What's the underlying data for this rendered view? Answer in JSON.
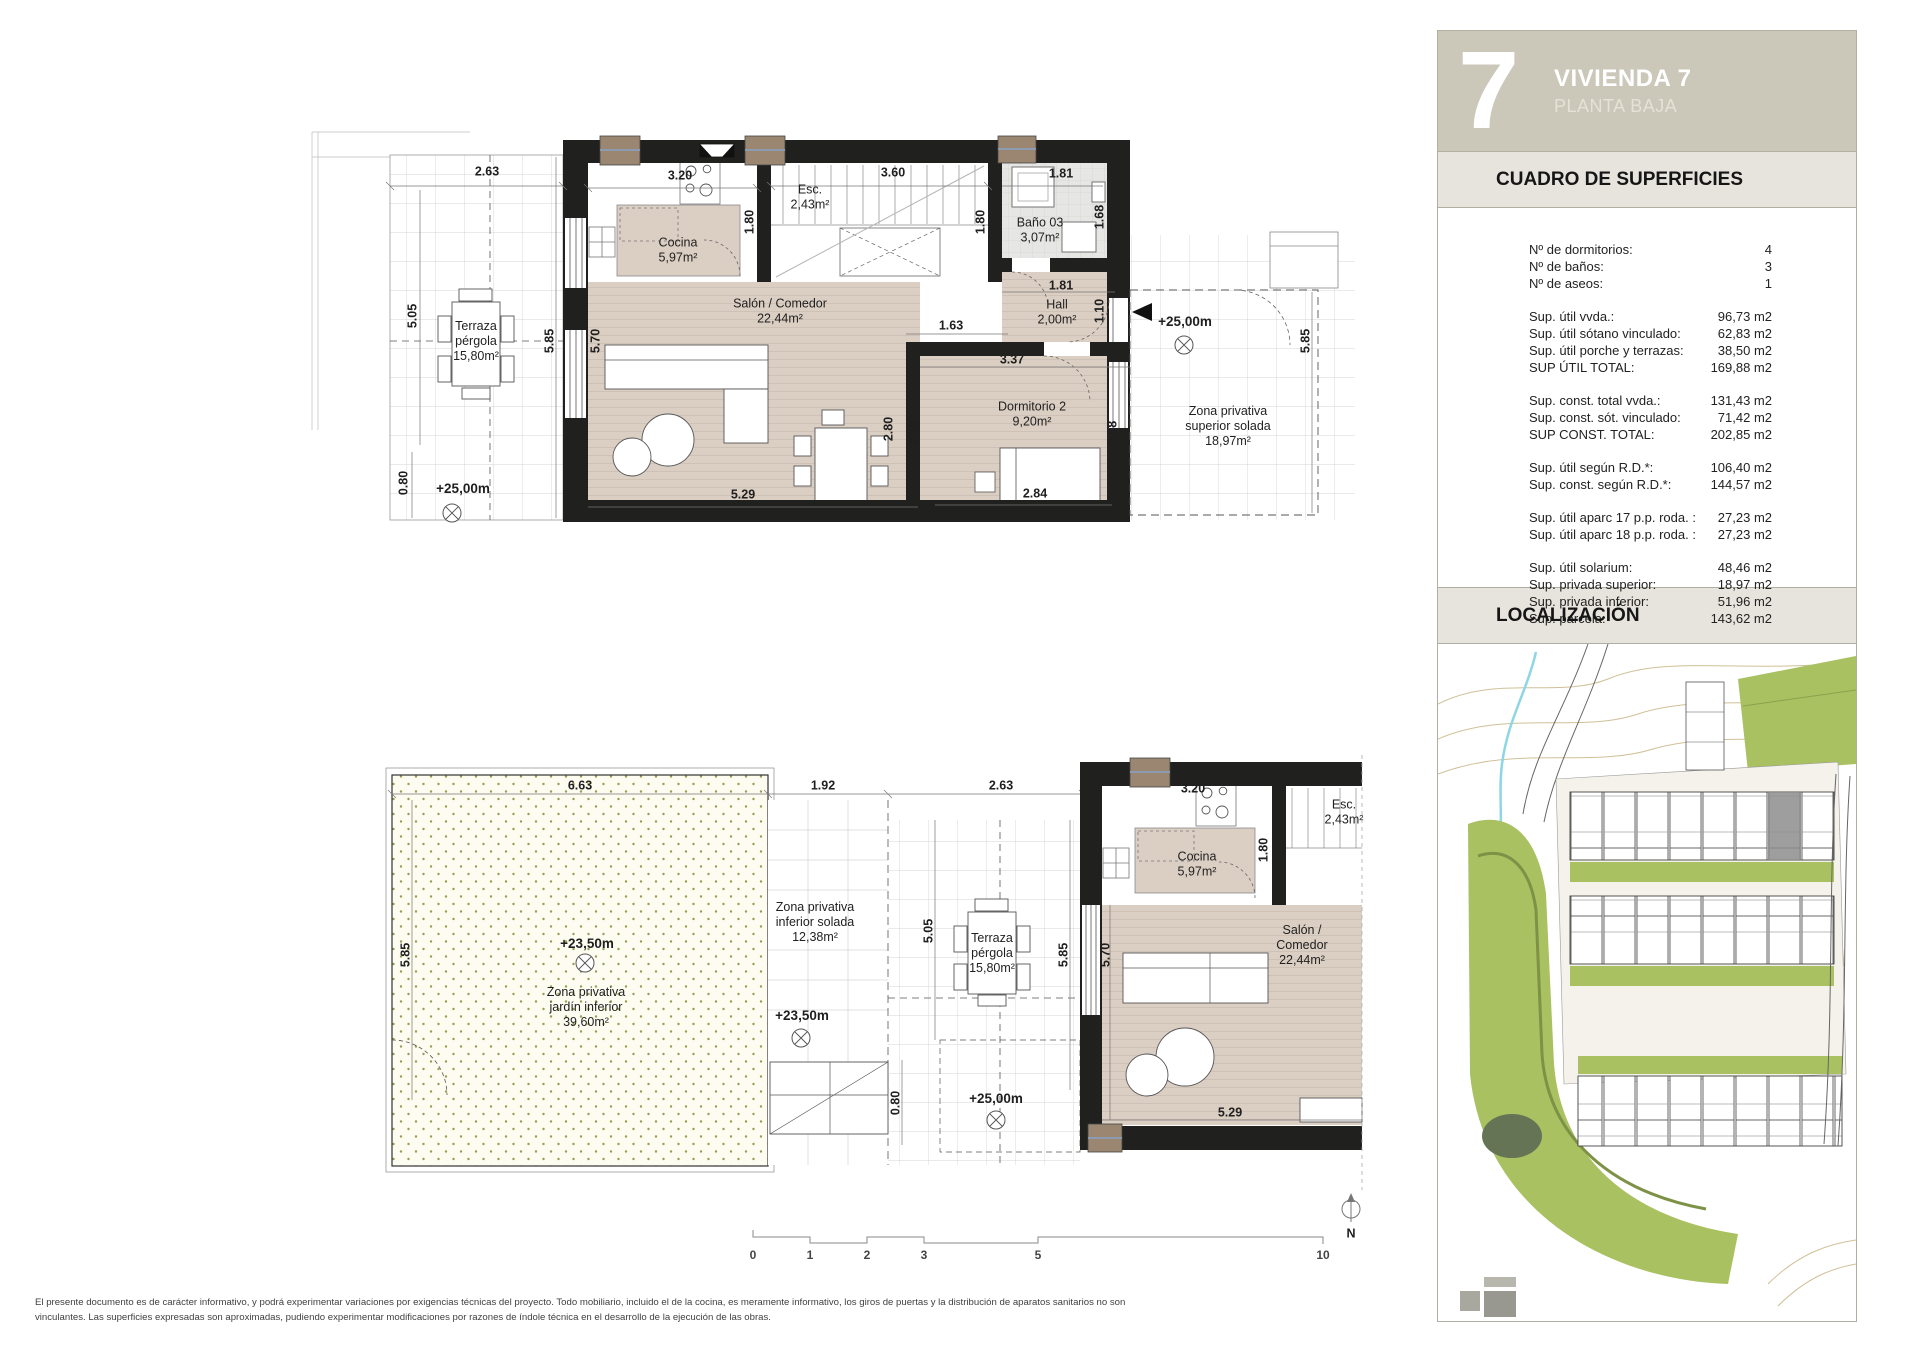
{
  "sidebar": {
    "unit_number": "7",
    "title": "VIVIENDA 7",
    "subtitle": "PLANTA BAJA",
    "surfaces_header": "CUADRO DE SUPERFICIES",
    "localization_header": "LOCALIZACIÓN",
    "surface_rows": [
      {
        "label": "Nº de dormitorios:",
        "value": "4"
      },
      {
        "label": "Nº de baños:",
        "value": "3"
      },
      {
        "label": "Nº de aseos:",
        "value": "1"
      },
      {
        "label": "Sup. útil vvda.:",
        "value": "96,73 m2",
        "gap": true
      },
      {
        "label": "Sup. útil sótano vinculado:",
        "value": "62,83 m2"
      },
      {
        "label": "Sup. útil porche y terrazas:",
        "value": "38,50 m2"
      },
      {
        "label": "SUP ÚTIL TOTAL:",
        "value": "169,88 m2"
      },
      {
        "label": "Sup. const. total vvda.:",
        "value": "131,43 m2",
        "gap": true
      },
      {
        "label": "Sup. const. sót. vinculado:",
        "value": "71,42 m2"
      },
      {
        "label": "SUP CONST. TOTAL:",
        "value": "202,85 m2"
      },
      {
        "label": "Sup. útil según R.D.*:",
        "value": "106,40 m2",
        "gap": true
      },
      {
        "label": "Sup. const. según R.D.*:",
        "value": "144,57 m2"
      },
      {
        "label": "Sup. útil aparc 17 p.p. roda. :",
        "value": "27,23 m2",
        "gap": true
      },
      {
        "label": "Sup. útil aparc 18 p.p. roda. :",
        "value": "27,23 m2"
      },
      {
        "label": "Sup. útil solarium:",
        "value": "48,46 m2",
        "gap": true
      },
      {
        "label": "Sup. privada superior:",
        "value": "18,97 m2"
      },
      {
        "label": "Sup. privada inferior:",
        "value": "51,96 m2"
      },
      {
        "label": "Sup. parcela:",
        "value": "143,62 m2"
      }
    ]
  },
  "plan_labels": [
    {
      "t": "2.63",
      "x": 487,
      "y": 172,
      "k": "dim"
    },
    {
      "t": "3.20",
      "x": 680,
      "y": 176,
      "k": "dim"
    },
    {
      "t": "3.60",
      "x": 893,
      "y": 173,
      "k": "dim"
    },
    {
      "t": "1.81",
      "x": 1061,
      "y": 174,
      "k": "dim"
    },
    {
      "t": "Esc.\n2,43m²",
      "x": 810,
      "y": 197,
      "k": "room"
    },
    {
      "t": "1.80",
      "x": 750,
      "y": 222,
      "k": "dim",
      "r": 1
    },
    {
      "t": "1.80",
      "x": 981,
      "y": 222,
      "k": "dim",
      "r": 1
    },
    {
      "t": "1.68",
      "x": 1100,
      "y": 217,
      "k": "dim",
      "r": 1
    },
    {
      "t": "Baño 03\n3,07m²",
      "x": 1040,
      "y": 230,
      "k": "room"
    },
    {
      "t": "Cocina\n5,97m²",
      "x": 678,
      "y": 250,
      "k": "room"
    },
    {
      "t": "Terraza\npérgola\n15,80m²",
      "x": 476,
      "y": 341,
      "k": "room"
    },
    {
      "t": "5.05",
      "x": 413,
      "y": 316,
      "k": "dim",
      "r": 1
    },
    {
      "t": "5.85",
      "x": 550,
      "y": 341,
      "k": "dim",
      "r": 1
    },
    {
      "t": "5.70",
      "x": 596,
      "y": 341,
      "k": "dim",
      "r": 1
    },
    {
      "t": "Salón / Comedor\n22,44m²",
      "x": 780,
      "y": 311,
      "k": "room"
    },
    {
      "t": "Hall\n2,00m²",
      "x": 1057,
      "y": 312,
      "k": "room"
    },
    {
      "t": "1.10",
      "x": 1100,
      "y": 311,
      "k": "dim",
      "r": 1
    },
    {
      "t": "1.81",
      "x": 1061,
      "y": 286,
      "k": "dim"
    },
    {
      "t": "1.63",
      "x": 951,
      "y": 326,
      "k": "dim"
    },
    {
      "t": "3.37",
      "x": 1012,
      "y": 360,
      "k": "dim"
    },
    {
      "t": "Dormitorio 2\n9,20m²",
      "x": 1032,
      "y": 414,
      "k": "room"
    },
    {
      "t": "2.80",
      "x": 889,
      "y": 429,
      "k": "dim",
      "r": 1
    },
    {
      "t": "2.58",
      "x": 915,
      "y": 433,
      "k": "dim",
      "r": 1
    },
    {
      "t": "2.68",
      "x": 1113,
      "y": 433,
      "k": "dim",
      "r": 1
    },
    {
      "t": "2.84",
      "x": 1035,
      "y": 494,
      "k": "dim"
    },
    {
      "t": "+25,00m",
      "x": 1185,
      "y": 322,
      "k": "lvl"
    },
    {
      "t": "Zona privativa\nsuperior solada\n18,97m²",
      "x": 1228,
      "y": 426,
      "k": "room"
    },
    {
      "t": "5.85",
      "x": 1306,
      "y": 341,
      "k": "dim",
      "r": 1
    },
    {
      "t": "+25,00m",
      "x": 463,
      "y": 489,
      "k": "lvl"
    },
    {
      "t": "0.80",
      "x": 404,
      "y": 483,
      "k": "dim",
      "r": 1
    },
    {
      "t": "5.29",
      "x": 743,
      "y": 495,
      "k": "dim"
    },
    {
      "t": "6.63",
      "x": 580,
      "y": 786,
      "k": "dim"
    },
    {
      "t": "1.92",
      "x": 823,
      "y": 786,
      "k": "dim"
    },
    {
      "t": "2.63",
      "x": 1001,
      "y": 786,
      "k": "dim"
    },
    {
      "t": "3.20",
      "x": 1193,
      "y": 789,
      "k": "dim"
    },
    {
      "t": "Esc.\n2,43m²",
      "x": 1344,
      "y": 812,
      "k": "room"
    },
    {
      "t": "1.80",
      "x": 1264,
      "y": 850,
      "k": "dim",
      "r": 1
    },
    {
      "t": "Cocina\n5,97m²",
      "x": 1197,
      "y": 864,
      "k": "room"
    },
    {
      "t": "5.85",
      "x": 406,
      "y": 955,
      "k": "dim",
      "r": 1
    },
    {
      "t": "+23,50m",
      "x": 587,
      "y": 944,
      "k": "lvl"
    },
    {
      "t": "Zona privativa\njardín inferior\n39,60m²",
      "x": 586,
      "y": 1007,
      "k": "room"
    },
    {
      "t": "Zona privativa\ninferior solada\n12,38m²",
      "x": 815,
      "y": 922,
      "k": "room"
    },
    {
      "t": "5.05",
      "x": 929,
      "y": 931,
      "k": "dim",
      "r": 1
    },
    {
      "t": "Terraza\npérgola\n15,80m²",
      "x": 992,
      "y": 953,
      "k": "room"
    },
    {
      "t": "5.85",
      "x": 1064,
      "y": 955,
      "k": "dim",
      "r": 1
    },
    {
      "t": "5.70",
      "x": 1106,
      "y": 955,
      "k": "dim",
      "r": 1
    },
    {
      "t": "+23,50m",
      "x": 802,
      "y": 1016,
      "k": "lvl"
    },
    {
      "t": "Salón / Comedor\n22,44m²",
      "x": 1302,
      "y": 945,
      "k": "room"
    },
    {
      "t": "0.80",
      "x": 896,
      "y": 1103,
      "k": "dim",
      "r": 1
    },
    {
      "t": "+25,00m",
      "x": 996,
      "y": 1099,
      "k": "lvl"
    },
    {
      "t": "5.29",
      "x": 1230,
      "y": 1113,
      "k": "dim"
    },
    {
      "t": "N",
      "x": 1351,
      "y": 1234,
      "k": "dim"
    }
  ],
  "scalebar": {
    "y": 1248,
    "ticks": [
      {
        "t": "0",
        "x": 753
      },
      {
        "t": "1",
        "x": 810
      },
      {
        "t": "2",
        "x": 867
      },
      {
        "t": "3",
        "x": 924
      },
      {
        "t": "5",
        "x": 1038
      },
      {
        "t": "10",
        "x": 1323
      }
    ]
  },
  "footer": {
    "disclaimer_line1": "El presente documento es de carácter informativo, y podrá experimentar variaciones por exigencias técnicas del proyecto. Todo mobiliario, incluido el de la cocina, es meramente informativo, los giros de puertas y la distribución de aparatos sanitarios no son",
    "disclaimer_line2": "vinculantes. Las superficies expresadas son aproximadas, pudiendo experimentar modificaciones por razones de índole técnica en el desarrollo de la ejecución de las obras."
  },
  "colors": {
    "header_bg": "#cbc7b9",
    "strip_bg": "#e6e4dd",
    "wall": "#20201e",
    "floor": "#dbcec3",
    "bath": "#e6e6e4",
    "garden_dot": "#9b9b53",
    "map_green": "#a9c161"
  }
}
